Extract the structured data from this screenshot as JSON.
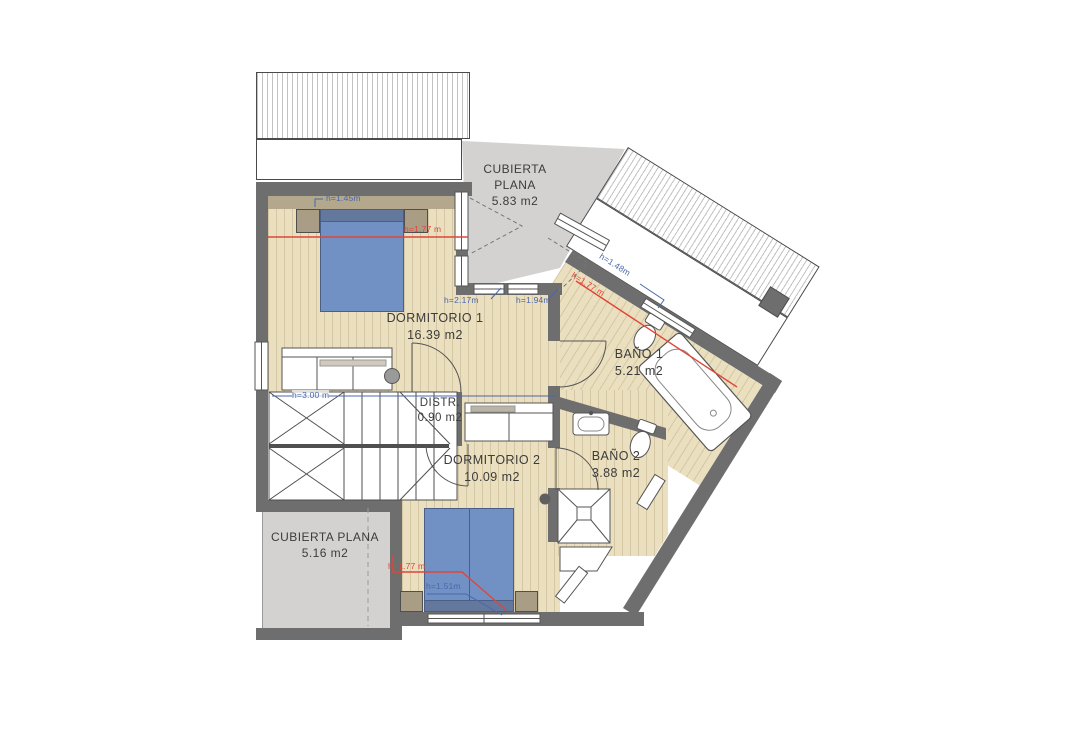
{
  "plan": {
    "rooms": {
      "dorm1": {
        "name": "DORMITORIO 1",
        "area": "16.39 m2"
      },
      "distr": {
        "name": "DISTR.",
        "area": "0.90 m2"
      },
      "dorm2": {
        "name": "DORMITORIO 2",
        "area": "10.09 m2"
      },
      "bano1": {
        "name": "BAÑO 1",
        "area": "5.21 m2"
      },
      "bano2": {
        "name": "BAÑO 2",
        "area": "3.88 m2"
      },
      "terrace_top": {
        "line1": "CUBIERTA",
        "line2": "PLANA",
        "area": "5.83 m2"
      },
      "terrace_left": {
        "name": "CUBIERTA PLANA",
        "area": "5.16 m2"
      }
    },
    "annotations": {
      "h145": "h=1.45m",
      "h177_dorm1": "h=1.77 m",
      "h217": "h=2.17m",
      "h194": "h=1.94m",
      "h148": "h=1.48m",
      "h177_wing": "h=1.77 m",
      "h300": "h=3.00 m",
      "h177_dorm2": "h=1.77 m",
      "h151": "h=1.51m"
    },
    "colors": {
      "wall": "#6f6e6e",
      "wood_floor": "#eadfbe",
      "terrace": "#d3d2d0",
      "bed": "#7191c4",
      "annotation_blue": "#4a67ad",
      "annotation_red": "#e0453a"
    }
  }
}
